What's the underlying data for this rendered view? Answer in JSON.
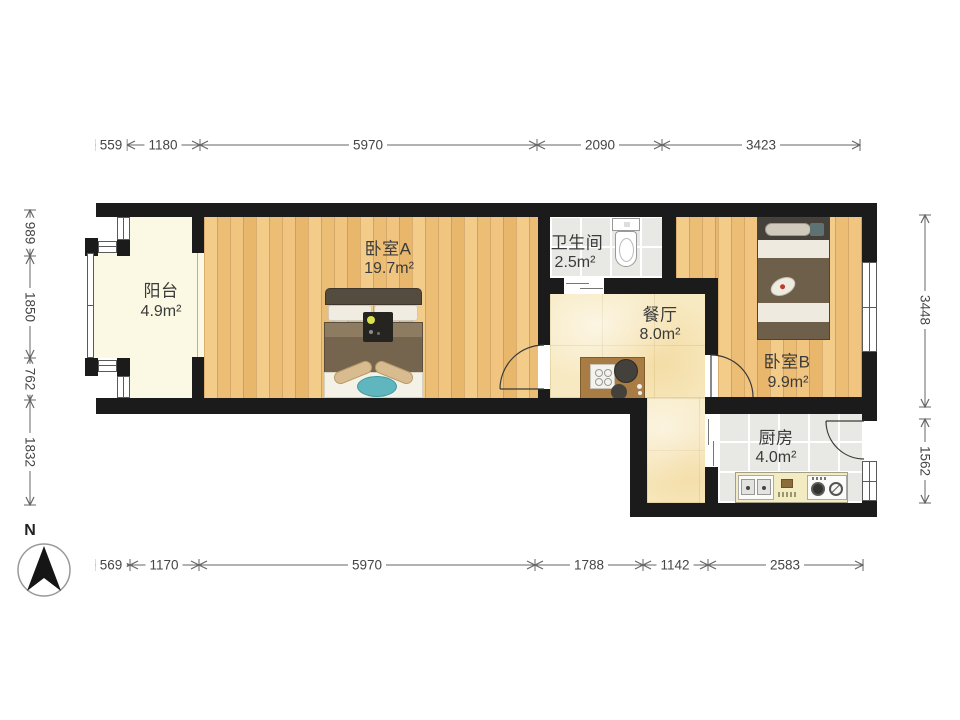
{
  "compass": {
    "north_label": "N"
  },
  "rooms": {
    "balcony": {
      "name": "阳台",
      "area": "4.9m²"
    },
    "bedroom_a": {
      "name": "卧室A",
      "area": "19.7m²"
    },
    "bathroom": {
      "name": "卫生间",
      "area": "2.5m²"
    },
    "dining": {
      "name": "餐厅",
      "area": "8.0m²"
    },
    "bedroom_b": {
      "name": "卧室B",
      "area": "9.9m²"
    },
    "kitchen": {
      "name": "厨房",
      "area": "4.0m²"
    }
  },
  "dimensions_mm": {
    "top": [
      "559",
      "1180",
      "5970",
      "2090",
      "3423"
    ],
    "bottom": [
      "569",
      "1170",
      "5970",
      "1788",
      "1142",
      "2583"
    ],
    "left": [
      "989",
      "1850",
      "762",
      "1832"
    ],
    "right": [
      "3448",
      "1562"
    ]
  },
  "colors": {
    "wall": "#1b1b1b",
    "wood_floor": "#f0c27e",
    "tile_floor": "#e8e8e5",
    "dining_floor": "#f7e9c1",
    "balcony_floor": "#fbf8e3",
    "rug_teal": "#5fb6be"
  }
}
